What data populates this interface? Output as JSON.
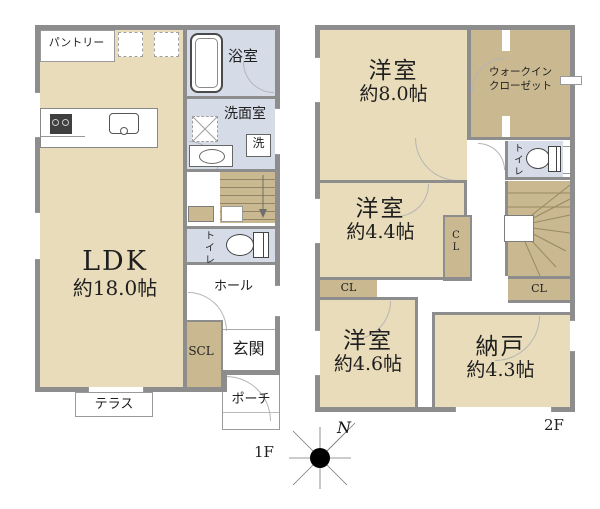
{
  "colors": {
    "room": "#e8dcba",
    "closet": "#c9b890",
    "wet": "#d6dbe8",
    "wall": "#8d8d8d",
    "line": "#555555",
    "text": "#1f1f1f"
  },
  "floor1": {
    "label": "1F",
    "ldk_name": "LDK",
    "ldk_size": "約18.0帖",
    "pantry": "パントリー",
    "bath": "浴室",
    "washroom": "洗面室",
    "washer": "洗",
    "toilet": "トイレ",
    "hall": "ホール",
    "scl": "SCL",
    "entrance": "玄関",
    "terrace": "テラス",
    "porch": "ポーチ"
  },
  "floor2": {
    "label": "2F",
    "room_a_name": "洋室",
    "room_a_size": "約8.0帖",
    "wic_line1": "ウォークイン",
    "wic_line2": "クローゼット",
    "toilet": "トイレ",
    "room_b_name": "洋室",
    "room_b_size": "約4.4帖",
    "closet_mid": "CL",
    "closet_left": "CL",
    "closet_right": "CL",
    "room_c_name": "洋室",
    "room_c_size": "約4.6帖",
    "storage_name": "納戸",
    "storage_size": "約4.3帖"
  },
  "compass": {
    "north": "N"
  }
}
